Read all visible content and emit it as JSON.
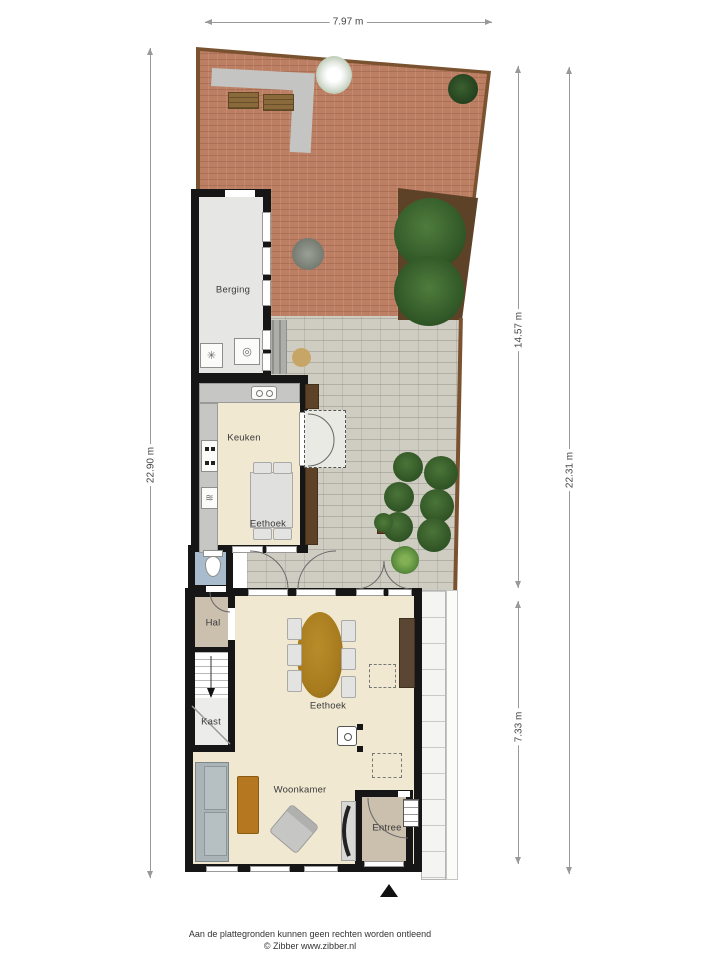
{
  "dimensions": {
    "top": "7.97 m",
    "left": "22.90 m",
    "right_outer": "22.31 m",
    "right_upper": "14.57 m",
    "right_lower": "7.33 m"
  },
  "rooms": {
    "berging": "Berging",
    "keuken": "Keuken",
    "eethoek_keuken": "Eethoek",
    "hal": "Hal",
    "kast": "Kast",
    "eethoek": "Eethoek",
    "woonkamer": "Woonkamer",
    "entree": "Entree"
  },
  "icons": {
    "dishwasher": "≋",
    "washer": "✳",
    "dryer": "◎"
  },
  "footer": {
    "disclaimer": "Aan de plattegronden kunnen geen rechten worden ontleend",
    "credit": "© Zibber www.zibber.nl"
  },
  "colors": {
    "wall": "#161616",
    "brick": "#bc7f63",
    "patio": "#cfccc2",
    "floor": "#f0e8d1",
    "floor_gray": "#e6e6e4",
    "hal_tan": "#cbbfae",
    "toilet_blue": "#a9bccd",
    "fence": "#7a5230",
    "bed": "#5e4228",
    "wood": "#b5771f",
    "ochre": "#a87c1e",
    "sofa": "#aab3b5",
    "dim": "#999999"
  }
}
